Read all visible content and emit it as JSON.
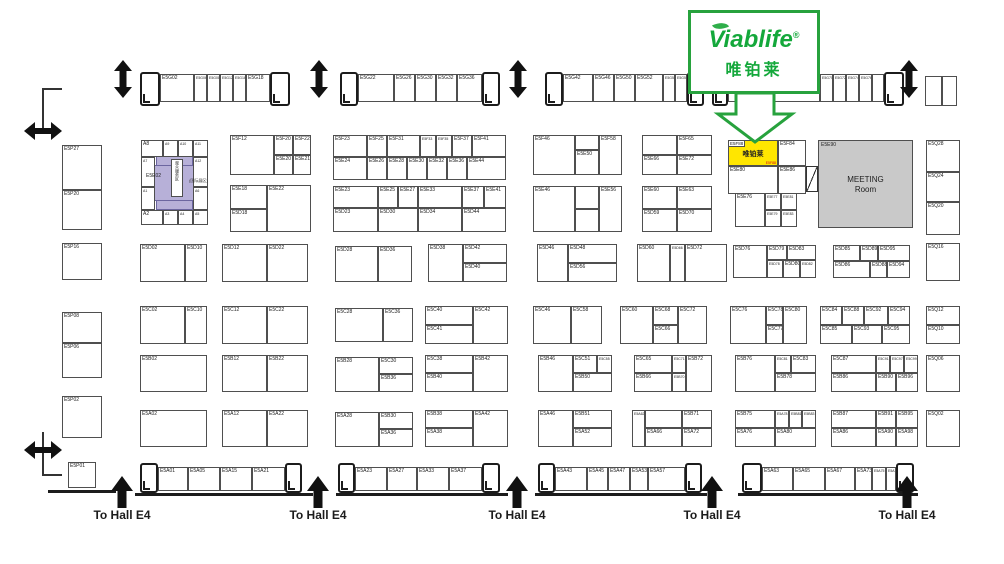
{
  "title": "Hall E5 Exhibition Floor Plan",
  "logo": {
    "brand": "Viablife",
    "reg": "®",
    "brand_cn": "唯铂莱",
    "green": "#27a23d"
  },
  "highlight_booth": {
    "id": "E5F88",
    "name_cn": "唯铂莱",
    "note": "E5F88",
    "fill": "#ffe600"
  },
  "meeting_room": {
    "id": "E5E90",
    "line1": "MEETING",
    "line2": "Room",
    "fill": "#c9c9c9"
  },
  "zone": {
    "id": "E5E02",
    "vertical_text": "观众服务区",
    "side_text": "(国际展区)",
    "fill": "#b7b0d8"
  },
  "hall_label": "To Hall E4",
  "hall_exits": {
    "y": 508,
    "centers": [
      122,
      318,
      517,
      712,
      907
    ]
  },
  "colors": {
    "accent_green": "#27a23d",
    "highlight_yellow": "#ffe600",
    "zone_purple": "#b7b0d8",
    "meeting_gray": "#c9c9c9",
    "note_red": "#d0021b",
    "line": "#4f4f4f"
  },
  "cells": [
    [
      "E5G02",
      160,
      74,
      34,
      28
    ],
    [
      "E5G06",
      194,
      74,
      13,
      28
    ],
    [
      "E5G08",
      207,
      74,
      13,
      28
    ],
    [
      "E5G12",
      220,
      74,
      13,
      28
    ],
    [
      "E5G16",
      233,
      74,
      13,
      28
    ],
    [
      "E5G18",
      246,
      74,
      24,
      28
    ],
    [
      "E5G22",
      358,
      74,
      36,
      28
    ],
    [
      "E5G26",
      394,
      74,
      21,
      28
    ],
    [
      "E5G30",
      415,
      74,
      21,
      28
    ],
    [
      "E5G32",
      436,
      74,
      21,
      28
    ],
    [
      "E5G36",
      457,
      74,
      25,
      28
    ],
    [
      "E5G42",
      563,
      74,
      30,
      28
    ],
    [
      "E5G46",
      593,
      74,
      21,
      28
    ],
    [
      "E5G50",
      614,
      74,
      21,
      28
    ],
    [
      "E5G52",
      635,
      74,
      28,
      28
    ],
    [
      "E5G56",
      663,
      74,
      12,
      28
    ],
    [
      "E5G58",
      675,
      74,
      12,
      28
    ],
    [
      "",
      728,
      74,
      92,
      28
    ],
    [
      "E5G70",
      820,
      74,
      13,
      28
    ],
    [
      "E5G72",
      833,
      74,
      13,
      28
    ],
    [
      "E5G74",
      846,
      74,
      13,
      28
    ],
    [
      "E5G76",
      859,
      74,
      13,
      28
    ],
    [
      "",
      872,
      74,
      12,
      28
    ],
    [
      "",
      925,
      76,
      17,
      30
    ],
    [
      "",
      942,
      76,
      15,
      30
    ],
    [
      "E5P27",
      62,
      145,
      40,
      45
    ],
    [
      "E5P20",
      62,
      190,
      40,
      40
    ],
    [
      "E5P16",
      62,
      243,
      40,
      37
    ],
    [
      "E5P08",
      62,
      312,
      40,
      31
    ],
    [
      "E5P06",
      62,
      343,
      40,
      35
    ],
    [
      "E5P02",
      62,
      396,
      40,
      42
    ],
    [
      "E5P01",
      68,
      462,
      28,
      26
    ],
    [
      "A8",
      141,
      140,
      22,
      17
    ],
    [
      "A9",
      163,
      140,
      15,
      17
    ],
    [
      "A10",
      178,
      140,
      15,
      17
    ],
    [
      "A11",
      193,
      140,
      15,
      17
    ],
    [
      "A7",
      141,
      157,
      14,
      30
    ],
    [
      "A12",
      193,
      157,
      15,
      30
    ],
    [
      "A1",
      141,
      187,
      14,
      23
    ],
    [
      "A6",
      193,
      187,
      15,
      23
    ],
    [
      "A2",
      141,
      210,
      22,
      15
    ],
    [
      "A3",
      163,
      210,
      15,
      15
    ],
    [
      "A4",
      178,
      210,
      15,
      15
    ],
    [
      "A5",
      193,
      210,
      15,
      15
    ],
    [
      "E5F12",
      230,
      135,
      44,
      40
    ],
    [
      "E5F20",
      274,
      135,
      19,
      20
    ],
    [
      "E5F22",
      293,
      135,
      18,
      20
    ],
    [
      "E5E20",
      274,
      155,
      19,
      20
    ],
    [
      "E5E21",
      293,
      155,
      18,
      20
    ],
    [
      "E5E18",
      230,
      185,
      37,
      24
    ],
    [
      "E5D18",
      230,
      209,
      37,
      23
    ],
    [
      "E5E22",
      267,
      185,
      44,
      47
    ],
    [
      "E5F23",
      333,
      135,
      34,
      22
    ],
    [
      "E5F25",
      367,
      135,
      20,
      22
    ],
    [
      "E5F31",
      387,
      135,
      33,
      22
    ],
    [
      "E5F33",
      420,
      135,
      16,
      22
    ],
    [
      "E5F35",
      436,
      135,
      16,
      22
    ],
    [
      "E5F37",
      452,
      135,
      20,
      22
    ],
    [
      "E5F41",
      472,
      135,
      34,
      22
    ],
    [
      "E5E24",
      333,
      157,
      34,
      23
    ],
    [
      "E5E26",
      367,
      157,
      20,
      23
    ],
    [
      "E5E28",
      387,
      157,
      20,
      23
    ],
    [
      "E5E30",
      407,
      157,
      20,
      23
    ],
    [
      "E5E32",
      427,
      157,
      20,
      23
    ],
    [
      "E5E36",
      447,
      157,
      20,
      23
    ],
    [
      "E5E44",
      467,
      157,
      39,
      23
    ],
    [
      "E5E23",
      333,
      186,
      45,
      22
    ],
    [
      "E5E25",
      378,
      186,
      20,
      22
    ],
    [
      "E5E27",
      398,
      186,
      20,
      22
    ],
    [
      "E5E33",
      418,
      186,
      44,
      22
    ],
    [
      "E5E37",
      462,
      186,
      22,
      22
    ],
    [
      "E5E41",
      484,
      186,
      22,
      22
    ],
    [
      "E5D23",
      333,
      208,
      45,
      24
    ],
    [
      "E5D30",
      378,
      208,
      40,
      24
    ],
    [
      "E5D34",
      418,
      208,
      44,
      24
    ],
    [
      "E5D44",
      462,
      208,
      44,
      24
    ],
    [
      "E5F46",
      533,
      135,
      42,
      40
    ],
    [
      "",
      575,
      135,
      24,
      15
    ],
    [
      "E5E50",
      575,
      150,
      24,
      25
    ],
    [
      "E5F58",
      599,
      135,
      23,
      40
    ],
    [
      "",
      642,
      135,
      35,
      20
    ],
    [
      "E5F65",
      677,
      135,
      35,
      20
    ],
    [
      "E5E66",
      642,
      155,
      35,
      20
    ],
    [
      "E5E72",
      677,
      155,
      35,
      20
    ],
    [
      "E5E46",
      533,
      186,
      42,
      46
    ],
    [
      "",
      575,
      186,
      24,
      23
    ],
    [
      "",
      575,
      209,
      24,
      23
    ],
    [
      "E5E56",
      599,
      186,
      23,
      46
    ],
    [
      "E5E60",
      642,
      186,
      35,
      23
    ],
    [
      "E5E63",
      677,
      186,
      35,
      23
    ],
    [
      "E5D59",
      642,
      209,
      35,
      23
    ],
    [
      "E5D70",
      677,
      209,
      35,
      23
    ],
    [
      "E5F84",
      778,
      140,
      28,
      26
    ],
    [
      "E5E80",
      728,
      166,
      50,
      28
    ],
    [
      "E5E86",
      778,
      166,
      28,
      28
    ],
    [
      "E5E76",
      735,
      193,
      30,
      34
    ],
    [
      "E5E77",
      765,
      193,
      16,
      17
    ],
    [
      "E5E81",
      781,
      193,
      16,
      17
    ],
    [
      "E5E79",
      765,
      210,
      16,
      17
    ],
    [
      "E5E83",
      781,
      210,
      16,
      17
    ],
    [
      "E5D02",
      140,
      244,
      45,
      38
    ],
    [
      "E5D10",
      185,
      244,
      22,
      38
    ],
    [
      "E5D12",
      222,
      244,
      45,
      38
    ],
    [
      "E5D22",
      267,
      244,
      41,
      38
    ],
    [
      "E5D28",
      335,
      246,
      43,
      36
    ],
    [
      "E5D36",
      378,
      246,
      34,
      36
    ],
    [
      "E5D38",
      428,
      244,
      35,
      38
    ],
    [
      "E5D42",
      463,
      244,
      44,
      19
    ],
    [
      "E5D40",
      463,
      263,
      44,
      19
    ],
    [
      "E5D46",
      537,
      244,
      31,
      38
    ],
    [
      "E5D48",
      568,
      244,
      49,
      19
    ],
    [
      "E5D56",
      568,
      263,
      49,
      19
    ],
    [
      "E5D60",
      637,
      244,
      33,
      38
    ],
    [
      "E5D66",
      670,
      244,
      15,
      38
    ],
    [
      "E5D72",
      685,
      244,
      42,
      38
    ],
    [
      "E5D76",
      733,
      245,
      34,
      33
    ],
    [
      "E5D79",
      767,
      245,
      20,
      15
    ],
    [
      "E5D83",
      787,
      245,
      29,
      15
    ],
    [
      "E5D78",
      767,
      260,
      16,
      18
    ],
    [
      "E5D80",
      783,
      260,
      17,
      18
    ],
    [
      "E5D82",
      800,
      260,
      16,
      18
    ],
    [
      "E5D85",
      833,
      245,
      27,
      16
    ],
    [
      "E5D89",
      860,
      245,
      18,
      16
    ],
    [
      "E5D95",
      878,
      245,
      32,
      16
    ],
    [
      "E5D86",
      833,
      261,
      37,
      17
    ],
    [
      "E5D88",
      870,
      261,
      17,
      17
    ],
    [
      "E5D94",
      887,
      261,
      23,
      17
    ],
    [
      "E5C02",
      140,
      306,
      45,
      38
    ],
    [
      "E5C10",
      185,
      306,
      22,
      38
    ],
    [
      "E5C12",
      222,
      306,
      45,
      38
    ],
    [
      "E5C22",
      267,
      306,
      41,
      38
    ],
    [
      "E5C28",
      335,
      308,
      48,
      34
    ],
    [
      "E5C36",
      383,
      308,
      30,
      34
    ],
    [
      "E5C40",
      425,
      306,
      48,
      19
    ],
    [
      "E5C41",
      425,
      325,
      48,
      19
    ],
    [
      "E5C42",
      473,
      306,
      35,
      38
    ],
    [
      "E5C46",
      533,
      306,
      38,
      38
    ],
    [
      "E5C58",
      571,
      306,
      31,
      38
    ],
    [
      "E5C60",
      620,
      306,
      33,
      38
    ],
    [
      "E5C68",
      653,
      306,
      25,
      19
    ],
    [
      "E5C66",
      653,
      325,
      25,
      19
    ],
    [
      "E5C72",
      678,
      306,
      29,
      38
    ],
    [
      "E5C76",
      730,
      306,
      36,
      38
    ],
    [
      "E5C78",
      766,
      306,
      17,
      19
    ],
    [
      "E5C77",
      766,
      325,
      17,
      19
    ],
    [
      "E5C80",
      783,
      306,
      24,
      38
    ],
    [
      "E5C84",
      820,
      306,
      22,
      19
    ],
    [
      "E5C88",
      842,
      306,
      22,
      19
    ],
    [
      "E5C92",
      864,
      306,
      24,
      19
    ],
    [
      "E5C94",
      888,
      306,
      22,
      19
    ],
    [
      "E5C85",
      820,
      325,
      32,
      19
    ],
    [
      "E5C93",
      852,
      325,
      30,
      19
    ],
    [
      "E5C95",
      882,
      325,
      28,
      19
    ],
    [
      "E5B02",
      140,
      355,
      67,
      37
    ],
    [
      "E5B12",
      222,
      355,
      45,
      37
    ],
    [
      "E5B22",
      267,
      355,
      41,
      37
    ],
    [
      "E5B28",
      335,
      357,
      44,
      35
    ],
    [
      "E5C30",
      379,
      357,
      34,
      17
    ],
    [
      "E5B36",
      379,
      374,
      34,
      18
    ],
    [
      "E5C38",
      425,
      355,
      48,
      18
    ],
    [
      "E5B40",
      425,
      373,
      48,
      19
    ],
    [
      "E5B42",
      473,
      355,
      35,
      37
    ],
    [
      "E5B46",
      538,
      355,
      35,
      37
    ],
    [
      "E5C51",
      573,
      355,
      24,
      18
    ],
    [
      "E5C55",
      597,
      355,
      15,
      18
    ],
    [
      "E5B50",
      573,
      373,
      39,
      19
    ],
    [
      "E5C65",
      634,
      355,
      38,
      18
    ],
    [
      "E5C71",
      672,
      355,
      14,
      18
    ],
    [
      "E5B72",
      686,
      355,
      26,
      37
    ],
    [
      "E5B66",
      634,
      373,
      38,
      19
    ],
    [
      "E5B70",
      672,
      373,
      14,
      19
    ],
    [
      "E5B76",
      735,
      355,
      40,
      37
    ],
    [
      "E5C81",
      775,
      355,
      16,
      18
    ],
    [
      "E5C83",
      791,
      355,
      25,
      18
    ],
    [
      "E5B78",
      775,
      373,
      41,
      19
    ],
    [
      "E5C87",
      831,
      355,
      45,
      18
    ],
    [
      "E5C91",
      876,
      355,
      14,
      18
    ],
    [
      "E5C97",
      890,
      355,
      14,
      18
    ],
    [
      "E5C99",
      904,
      355,
      14,
      18
    ],
    [
      "E5B86",
      831,
      373,
      45,
      19
    ],
    [
      "E5B90",
      876,
      373,
      20,
      19
    ],
    [
      "E5B96",
      896,
      373,
      22,
      19
    ],
    [
      "E5A02",
      140,
      410,
      67,
      37
    ],
    [
      "E5A12",
      222,
      410,
      45,
      37
    ],
    [
      "E5A22",
      267,
      410,
      41,
      37
    ],
    [
      "E5A28",
      335,
      412,
      44,
      35
    ],
    [
      "E5B30",
      379,
      412,
      34,
      17
    ],
    [
      "E5A36",
      379,
      429,
      34,
      18
    ],
    [
      "E5B38",
      425,
      410,
      48,
      18
    ],
    [
      "E5A38",
      425,
      428,
      48,
      19
    ],
    [
      "E5A42",
      473,
      410,
      35,
      37
    ],
    [
      "E5A46",
      538,
      410,
      35,
      37
    ],
    [
      "E5B51",
      573,
      410,
      39,
      18
    ],
    [
      "E5A52",
      573,
      428,
      39,
      19
    ],
    [
      "E5A62",
      632,
      410,
      13,
      37
    ],
    [
      "",
      645,
      410,
      37,
      18
    ],
    [
      "E5B71",
      682,
      410,
      30,
      18
    ],
    [
      "E5A66",
      645,
      428,
      37,
      19
    ],
    [
      "E5A72",
      682,
      428,
      30,
      19
    ],
    [
      "E5B75",
      735,
      410,
      40,
      18
    ],
    [
      "E5A78",
      775,
      410,
      14,
      18
    ],
    [
      "E5B81",
      789,
      410,
      13,
      18
    ],
    [
      "E5B83",
      802,
      410,
      14,
      18
    ],
    [
      "E5A76",
      735,
      428,
      40,
      19
    ],
    [
      "E5A80",
      775,
      428,
      41,
      19
    ],
    [
      "E5B87",
      831,
      410,
      45,
      18
    ],
    [
      "E5B91",
      876,
      410,
      20,
      18
    ],
    [
      "E5B95",
      896,
      410,
      22,
      18
    ],
    [
      "E5A86",
      831,
      428,
      45,
      19
    ],
    [
      "E5A90",
      876,
      428,
      20,
      19
    ],
    [
      "E5A98",
      896,
      428,
      22,
      19
    ],
    [
      "E5A01",
      158,
      467,
      30,
      24
    ],
    [
      "E5A05",
      188,
      467,
      32,
      24
    ],
    [
      "E5A15",
      220,
      467,
      32,
      24
    ],
    [
      "E5A21",
      252,
      467,
      33,
      24
    ],
    [
      "E5A23",
      355,
      467,
      32,
      24
    ],
    [
      "E5A27",
      387,
      467,
      30,
      24
    ],
    [
      "E5A33",
      417,
      467,
      32,
      24
    ],
    [
      "E5A37",
      449,
      467,
      33,
      24
    ],
    [
      "E5A43",
      555,
      467,
      32,
      24
    ],
    [
      "E5A45",
      587,
      467,
      21,
      24
    ],
    [
      "E5A47",
      608,
      467,
      22,
      24
    ],
    [
      "E5A53",
      630,
      467,
      18,
      24
    ],
    [
      "E5A57",
      648,
      467,
      37,
      24
    ],
    [
      "E5A63",
      762,
      467,
      31,
      24
    ],
    [
      "E5A65",
      793,
      467,
      32,
      24
    ],
    [
      "E5A67",
      825,
      467,
      30,
      24
    ],
    [
      "E5A73",
      855,
      467,
      17,
      24
    ],
    [
      "E5A75",
      872,
      467,
      14,
      24
    ],
    [
      "E5A79",
      886,
      467,
      10,
      24
    ],
    [
      "E5Q28",
      926,
      140,
      34,
      32
    ],
    [
      "E5Q24",
      926,
      172,
      34,
      30
    ],
    [
      "E5Q20",
      926,
      202,
      34,
      33
    ],
    [
      "E5Q16",
      926,
      243,
      34,
      38
    ],
    [
      "E5Q12",
      926,
      306,
      34,
      19
    ],
    [
      "E5Q10",
      926,
      325,
      34,
      19
    ],
    [
      "E5Q06",
      926,
      355,
      34,
      37
    ],
    [
      "E5Q02",
      926,
      410,
      34,
      37
    ]
  ],
  "posts": [
    [
      140,
      72,
      20,
      34
    ],
    [
      270,
      72,
      20,
      34
    ],
    [
      340,
      72,
      18,
      34
    ],
    [
      482,
      72,
      18,
      34
    ],
    [
      545,
      72,
      18,
      34
    ],
    [
      687,
      72,
      17,
      34
    ],
    [
      712,
      72,
      16,
      34
    ],
    [
      884,
      72,
      20,
      34
    ],
    [
      140,
      463,
      18,
      30
    ],
    [
      285,
      463,
      17,
      30
    ],
    [
      338,
      463,
      17,
      30
    ],
    [
      482,
      463,
      18,
      30
    ],
    [
      538,
      463,
      17,
      30
    ],
    [
      685,
      463,
      17,
      30
    ],
    [
      742,
      463,
      20,
      30
    ],
    [
      896,
      463,
      18,
      30
    ]
  ],
  "baselines": [
    [
      135,
      493,
      178
    ],
    [
      336,
      493,
      172
    ],
    [
      535,
      493,
      172
    ],
    [
      738,
      493,
      180
    ],
    [
      48,
      490,
      68
    ]
  ],
  "walls": [
    {
      "x": 42,
      "y": 88,
      "w": 20,
      "h": 44,
      "sides": "tl"
    },
    {
      "x": 42,
      "y": 432,
      "w": 20,
      "h": 44,
      "sides": "bl"
    }
  ],
  "arrows": {
    "vertical": [
      [
        113,
        60
      ],
      [
        309,
        60
      ],
      [
        508,
        60
      ],
      [
        899,
        60
      ]
    ],
    "horizontal": [
      [
        24,
        122
      ],
      [
        24,
        441
      ]
    ],
    "up": [
      [
        111,
        476
      ],
      [
        307,
        476
      ],
      [
        506,
        476
      ],
      [
        701,
        476
      ],
      [
        896,
        476
      ]
    ]
  }
}
